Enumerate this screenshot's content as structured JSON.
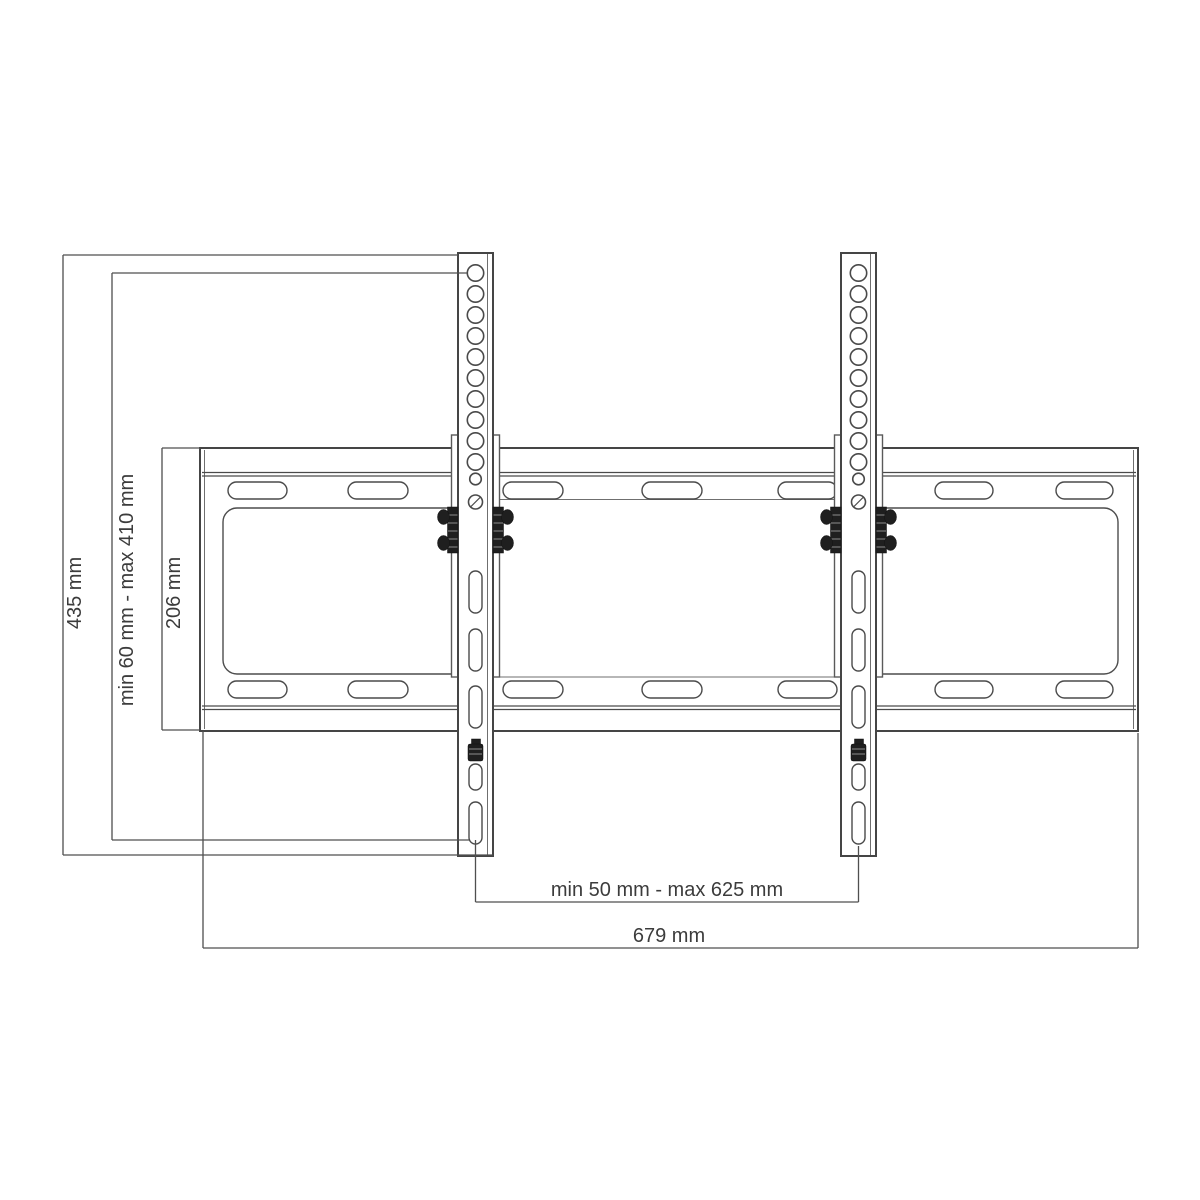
{
  "drawing": {
    "type": "technical-dimension-drawing",
    "subject": "tilting TV wall mount bracket - front view",
    "labels": {
      "bracket_height": "435 mm",
      "vertical_adjust_range": "min 60 mm - max 410 mm",
      "wall_plate_height": "206 mm",
      "horizontal_adjust_range": "min 50 mm - max 625 mm",
      "wall_plate_width": "679 mm"
    },
    "parts": {
      "vertical_bracket_arms": 2,
      "round_holes_per_arm": 11,
      "adjustment_slots_per_arm": 5,
      "wall_plate_top_slots": 7,
      "wall_plate_bottom_slots": 7
    },
    "colors": {
      "background": "#ffffff",
      "part_line": "#454545",
      "dimension_line": "#4f4f4f",
      "text": "#3c3c3c",
      "hardware": "#1f1f1f"
    }
  }
}
